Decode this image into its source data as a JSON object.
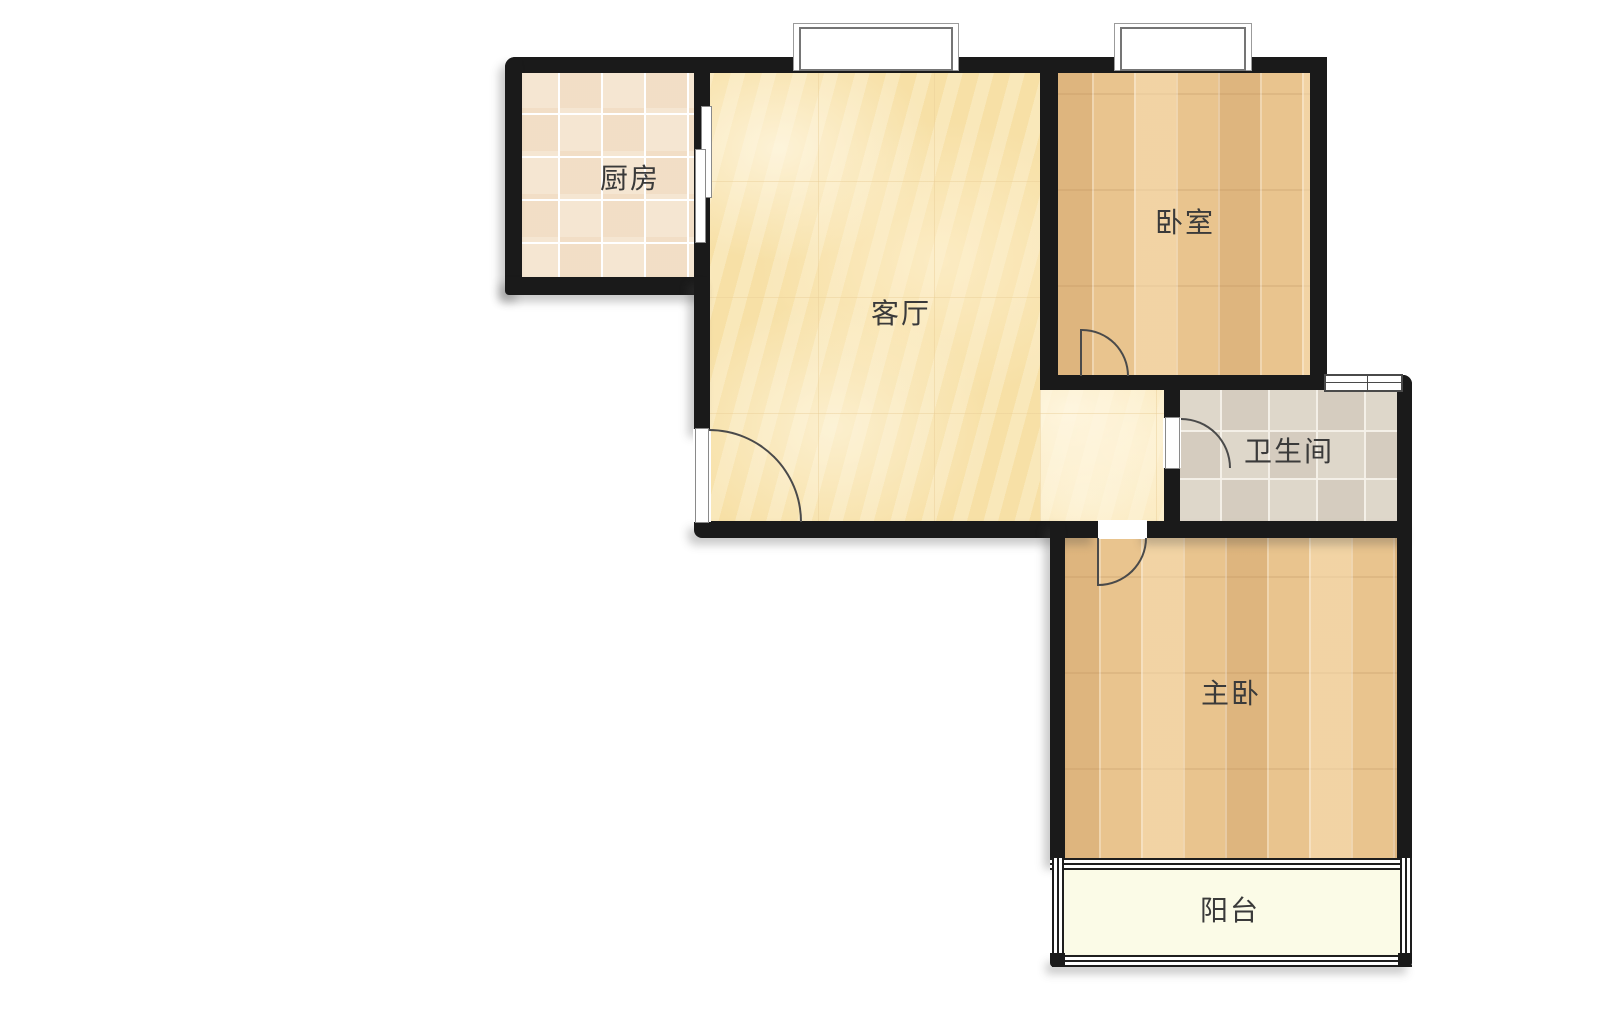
{
  "floorplan": {
    "type": "apartment floor plan",
    "background": "#ffffff",
    "wall_color": "#1a1a1a",
    "rooms": {
      "kitchen": {
        "label": "厨房",
        "floor": "beige ceramic tile",
        "floor_color": "#f5e6d2"
      },
      "living_room": {
        "label": "客厅",
        "floor": "pale yellow marble",
        "floor_color": "#f8e3ae"
      },
      "bedroom": {
        "label": "卧室",
        "floor": "light oak plank",
        "floor_color": "#e9c48e"
      },
      "bathroom": {
        "label": "卫生间",
        "floor": "grey ceramic tile",
        "floor_color": "#ded7ca"
      },
      "master_bedroom": {
        "label": "主卧",
        "floor": "light oak plank",
        "floor_color": "#e9c48e"
      },
      "balcony": {
        "label": "阳台",
        "floor": "plain cream",
        "floor_color": "#fbfbe7"
      }
    },
    "doors": [
      "entry swing door on living room left wall",
      "kitchen sliding door",
      "bedroom swing door",
      "bathroom swing door",
      "master bedroom swing door"
    ],
    "windows": [
      "living room top window",
      "bedroom top window",
      "bathroom right window",
      "balcony glazed walls (left, bottom, right)"
    ]
  }
}
